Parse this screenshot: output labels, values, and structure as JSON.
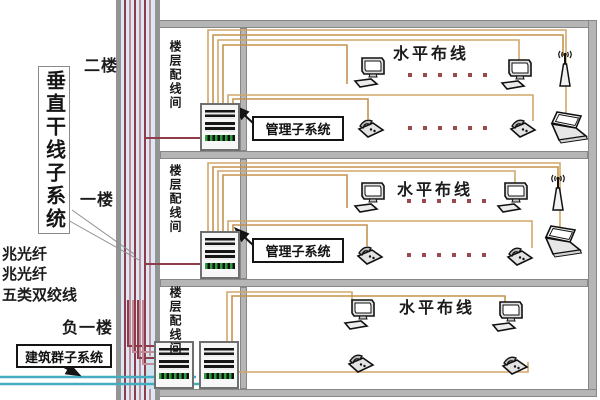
{
  "labels": {
    "vertical_backbone": "垂直干线子系统",
    "campus_subsystem": "建筑群子系统",
    "management_subsystem": "管理子系统",
    "horizontal_cabling": "水平布线",
    "floor_wiring_room": "楼层配线间"
  },
  "floor_labels": {
    "second": "二楼",
    "first": "一楼",
    "basement": "负一楼"
  },
  "cable_labels": {
    "fiber_a": "兆光纤",
    "fiber_b": "兆光纤",
    "twisted_pair": "五类双绞线"
  },
  "floors": [
    {
      "label": "二楼",
      "room": "楼层配线间",
      "area": "水平布线",
      "racks": 1,
      "devices": [
        "computer",
        "computer",
        "antenna",
        "phone",
        "phone",
        "laptop"
      ],
      "ellipsis_rows": 2,
      "ellipsis_dots": 6
    },
    {
      "label": "一楼",
      "room": "楼层配线间",
      "area": "水平布线",
      "racks": 1,
      "devices": [
        "computer",
        "computer",
        "antenna",
        "phone",
        "phone",
        "laptop"
      ],
      "ellipsis_rows": 2,
      "ellipsis_dots": 6
    },
    {
      "label": "负一楼",
      "room": "楼层配线间",
      "area": "水平布线",
      "racks": 2,
      "devices": [
        "computer",
        "computer",
        "phone",
        "phone"
      ],
      "ellipsis_rows": 0,
      "ellipsis_dots": 0
    }
  ],
  "icons": {
    "computer": "desktop-computer-icon",
    "phone": "telephone-icon",
    "antenna": "wireless-antenna-icon",
    "laptop": "laptop-icon",
    "rack": "equipment-rack"
  },
  "colors": {
    "wall": "#b5b5b5",
    "shaft_background": "#dce8f3",
    "backbone_dark": "#8e3b4a",
    "backbone_light": "#c08d99",
    "horizontal_cable": "#d2a76a",
    "horizontal_cable_alt": "#c5924f",
    "campus_cable": "#45adc0",
    "rack_green": "#2f9e41",
    "text": "#1b1b1b"
  }
}
